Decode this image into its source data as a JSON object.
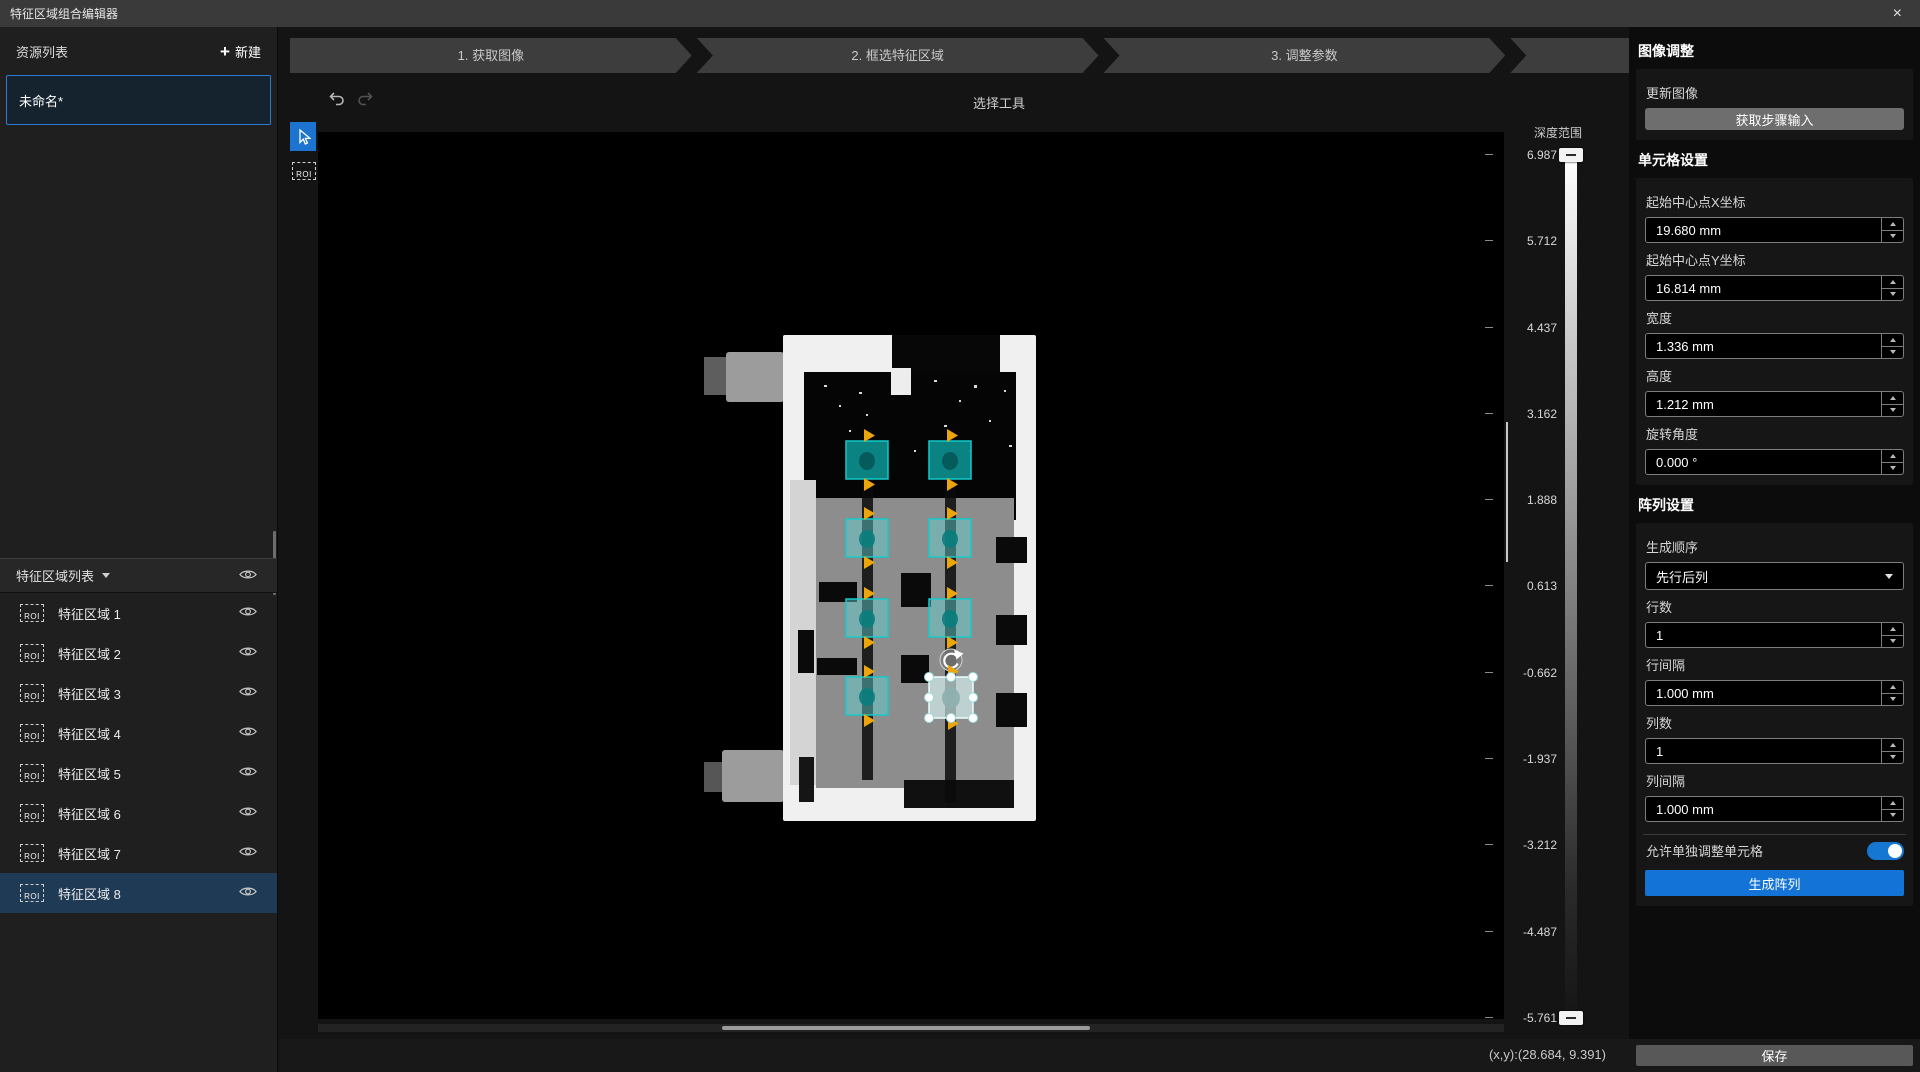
{
  "window": {
    "title": "特征区域组合编辑器",
    "close_icon": "×"
  },
  "stepper": {
    "steps": [
      "1. 获取图像",
      "2. 框选特征区域",
      "3. 调整参数",
      "4. 生成特征区域阵列"
    ]
  },
  "sidebar": {
    "resources": {
      "title": "资源列表",
      "new_icon": "+",
      "new_label": "新建",
      "items": [
        {
          "name": "未命名*"
        }
      ]
    },
    "region_list": {
      "title": "特征区域列表",
      "roi_icon_label": "ROI",
      "items": [
        "特征区域 1",
        "特征区域 2",
        "特征区域 3",
        "特征区域 4",
        "特征区域 5",
        "特征区域 6",
        "特征区域 7",
        "特征区域 8"
      ],
      "selected": "特征区域 8"
    }
  },
  "canvas": {
    "toolbar": {
      "tool_label": "选择工具"
    },
    "roi_icon_label": "ROI",
    "roi_count": 8
  },
  "depth_scale": {
    "title": "深度范围",
    "ticks": [
      "6.987",
      "5.712",
      "4.437",
      "3.162",
      "1.888",
      "0.613",
      "-0.662",
      "-1.937",
      "-3.212",
      "-4.487",
      "-5.761"
    ]
  },
  "right_panel": {
    "image_adjust": {
      "title": "图像调整",
      "update_label": "更新图像",
      "fetch_button": "获取步骤输入"
    },
    "cell_settings": {
      "title": "单元格设置",
      "fields": [
        {
          "label": "起始中心点X坐标",
          "value": "19.680 mm"
        },
        {
          "label": "起始中心点Y坐标",
          "value": "16.814 mm"
        },
        {
          "label": "宽度",
          "value": "1.336 mm"
        },
        {
          "label": "高度",
          "value": "1.212 mm"
        },
        {
          "label": "旋转角度",
          "value": "0.000 °"
        }
      ]
    },
    "array_settings": {
      "title": "阵列设置",
      "order": {
        "label": "生成顺序",
        "value": "先行后列"
      },
      "fields": [
        {
          "label": "行数",
          "value": "1"
        },
        {
          "label": "行间隔",
          "value": "1.000 mm"
        },
        {
          "label": "列数",
          "value": "1"
        },
        {
          "label": "列间隔",
          "value": "1.000 mm"
        }
      ],
      "allow_label": "允许单独调整单元格",
      "toggle_on": true,
      "generate_button": "生成阵列"
    }
  },
  "status_bar": {
    "coords": "(x,y):(28.684, 9.391)",
    "save_button": "保存"
  },
  "colors": {
    "accent_blue": "#1677d2",
    "roi_teal": "#19c7c7",
    "marker_yellow": "#efa900",
    "selection_border": "#2e7bd2"
  }
}
